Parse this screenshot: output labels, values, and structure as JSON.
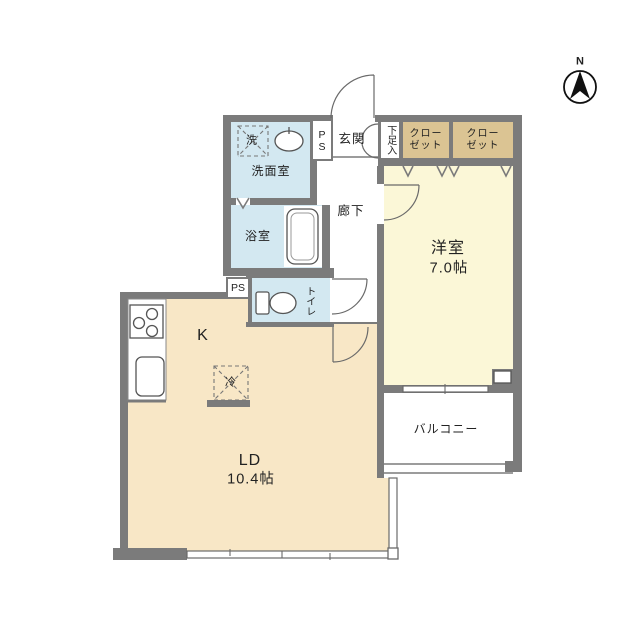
{
  "plan": {
    "compass_label": "N",
    "rooms": {
      "entrance": "玄関",
      "shoe_storage": "下足入",
      "closet_left_line1": "クロー",
      "closet_left_line2": "ゼット",
      "closet_right_line1": "クロー",
      "closet_right_line2": "ゼット",
      "washroom": "洗面室",
      "washing_machine": "洗",
      "bathroom": "浴室",
      "corridor": "廊下",
      "toilet": "トイレ",
      "pipe_space_upper": "PS",
      "pipe_space_lower": "PS",
      "western_room_name": "洋室",
      "western_room_size": "7.0帖",
      "kitchen": "K",
      "refrigerator": "冷",
      "living_dining_name": "LD",
      "living_dining_size": "10.4帖",
      "balcony": "バルコニー"
    },
    "colors": {
      "wall": "#7b7b7b",
      "room_yellow": "#fbf7d7",
      "room_peach": "#f8e7c6",
      "room_blue": "#d3e8f1",
      "closet_tan": "#dbc493",
      "outline": "#555555",
      "text": "#222222",
      "background": "#ffffff"
    }
  }
}
